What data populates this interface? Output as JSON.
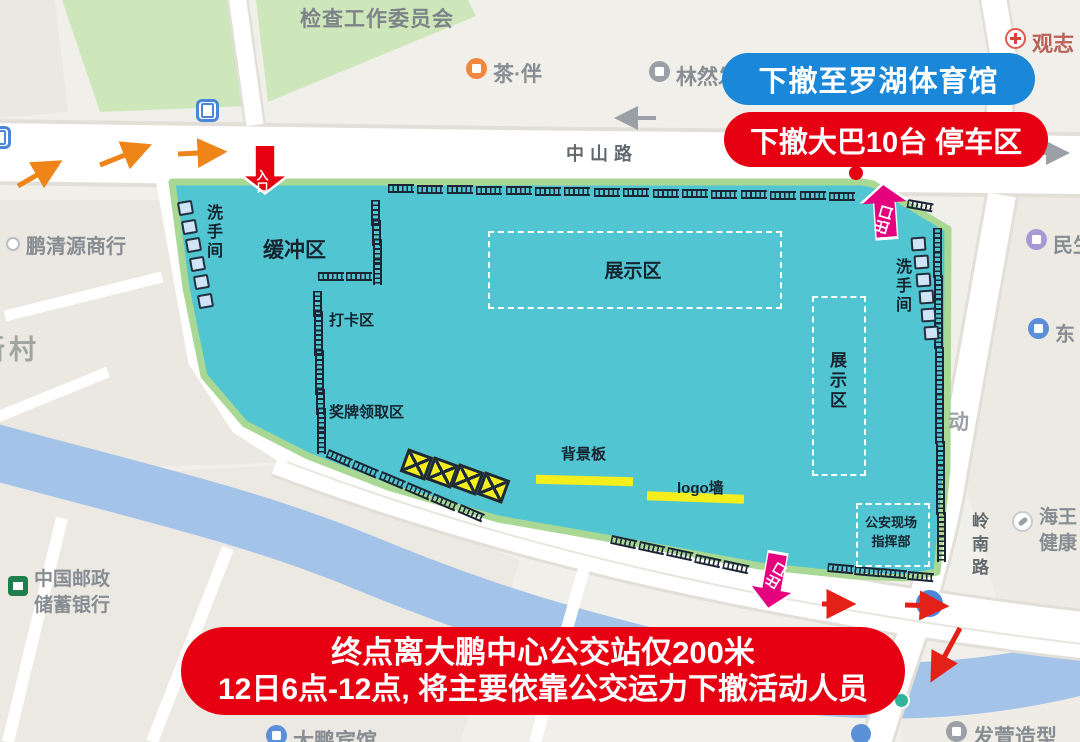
{
  "banners": {
    "retreat_destination": "下撤至罗湖体育馆",
    "retreat_bus": "下撤大巴10台 停车区",
    "bottom_line1": "终点离大鹏中心公交站仅200米",
    "bottom_line2": "12日6点-12点, 将主要依靠公交运力下撤活动人员"
  },
  "gates": {
    "entrance": "入口",
    "exit_top": "出口",
    "exit_bottom": "出口"
  },
  "zones": {
    "buffer": "缓冲区",
    "exhibition_center": "展示区",
    "exhibition_east": "展示区",
    "checkin": "打卡区",
    "medal": "奖牌领取区",
    "backdrop": "背景板",
    "logo_wall": "logo墙",
    "police_line1": "公安现场",
    "police_line2": "指挥部",
    "toilet_west": "洗手间",
    "toilet_east": "洗手间"
  },
  "roads": {
    "zhongshan": "中山路",
    "lingnan": "岭南路"
  },
  "pois": {
    "committee": "检查工作委员会",
    "tea_house": "茶·伴",
    "linranfa": "林然发",
    "guanzhi": "观志",
    "pengqingyuan": "鹏清源商行",
    "xincun": "新村",
    "post_bank_line1": "中国邮政",
    "post_bank_line2": "储蓄银行",
    "dapeng_hotel": "大鹏宾馆",
    "faxuan_salon": "发萱造型",
    "minsheng": "民生",
    "dong_east": "东",
    "haiwang_line1": "海王",
    "haiwang_line2": "健康",
    "dong_partial": "动"
  },
  "furniture": {
    "barrier_rows": [
      {
        "x": 388,
        "y": 184,
        "count": 16,
        "dx": 29.4,
        "dy": 0.5,
        "angle": 0
      },
      {
        "x": 908,
        "y": 199,
        "count": 1,
        "dx": 0,
        "dy": 0,
        "angle": 10
      },
      {
        "x": 380,
        "y": 200,
        "count": 4,
        "dx": 0.8,
        "dy": 19.6,
        "angle": 90
      },
      {
        "x": 318,
        "y": 272,
        "count": 2,
        "dx": 28,
        "dy": 0,
        "angle": 0
      },
      {
        "x": 322,
        "y": 291,
        "count": 8,
        "dx": 0.6,
        "dy": 19.5,
        "angle": 90
      },
      {
        "x": 329,
        "y": 449,
        "count": 6,
        "dx": 26.3,
        "dy": 11,
        "angle": 23
      },
      {
        "x": 612,
        "y": 535,
        "count": 5,
        "dx": 28,
        "dy": 6.2,
        "angle": 12
      },
      {
        "x": 828,
        "y": 563,
        "count": 4,
        "dx": 26.5,
        "dy": 2.6,
        "angle": 5
      },
      {
        "x": 942,
        "y": 228,
        "count": 14,
        "dx": 0.3,
        "dy": 23.7,
        "angle": 90
      }
    ],
    "toilet_rows": [
      {
        "x": 178,
        "y": 201,
        "count": 6,
        "dx": 4.0,
        "dy": 18.5,
        "angle": -10
      },
      {
        "x": 911,
        "y": 237,
        "count": 6,
        "dx": 2.6,
        "dy": 17.8,
        "angle": -4
      }
    ],
    "yellow_boxes": {
      "x": 403,
      "y": 452,
      "count": 4,
      "dx": 25.5,
      "dy": 7.6,
      "size": 27,
      "angle": 20
    }
  },
  "colors": {
    "venue": "#52c5d2",
    "venue_edge": "#a8d894",
    "banner_blue": "#1b87d9",
    "banner_red": "#e60012",
    "gate_magenta": "#e5007e",
    "arrow_orange": "#ef8418",
    "highlight_yellow": "#f4ee1c",
    "barrier_dark": "#1a2633",
    "river": "#a4c3e9",
    "park": "#cde7bb",
    "map_bg": "#f1efe9"
  }
}
